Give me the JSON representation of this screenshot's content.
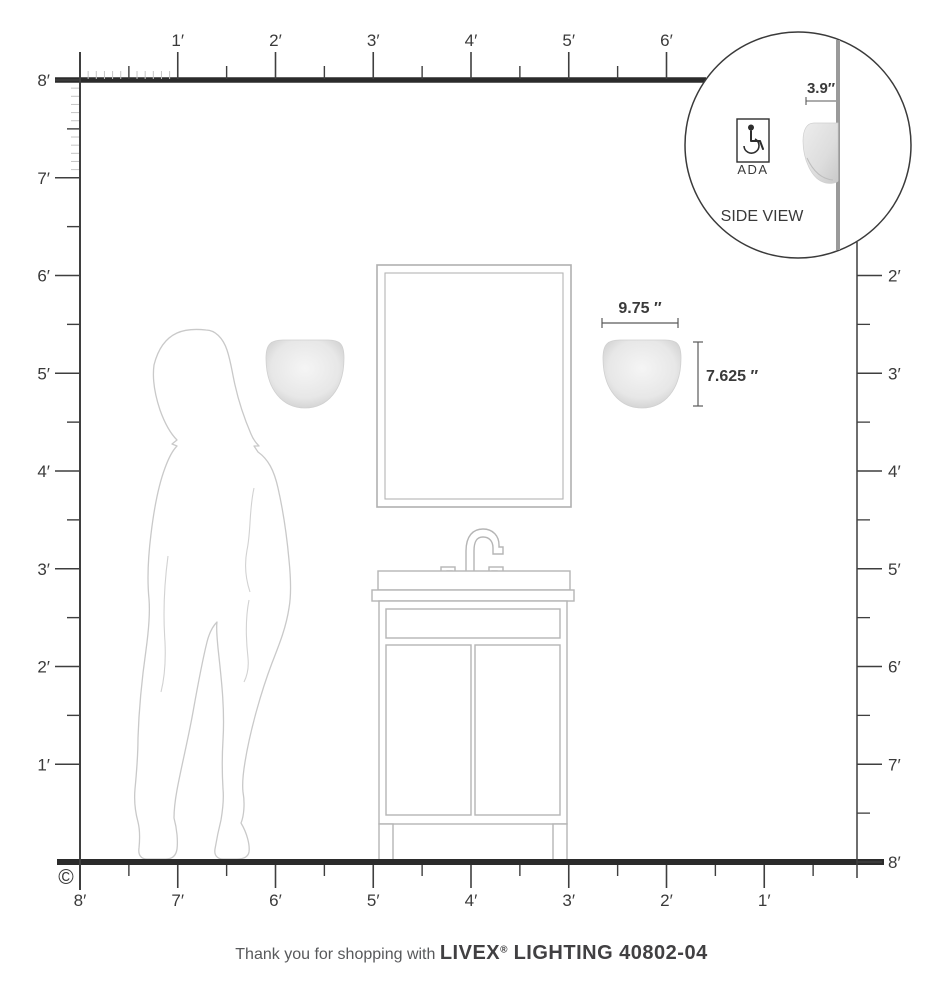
{
  "page": {
    "copyright": "©"
  },
  "footer": {
    "prefix": "Thank you for shopping with ",
    "brand": "LIVEX",
    "registered": "®",
    "suffix": " LIGHTING 40802-04"
  },
  "inset": {
    "dimension_label": "3.9″",
    "ada_label": "ADA",
    "view_label": "SIDE VIEW"
  },
  "fixture_dimensions": {
    "width_label": "9.75 ″",
    "height_label": "7.625 ″"
  },
  "rulers": {
    "top_labels": [
      "1′",
      "2′",
      "3′",
      "4′",
      "5′",
      "6′"
    ],
    "left_labels": [
      "8′",
      "7′",
      "6′",
      "5′",
      "4′",
      "3′",
      "2′",
      "1′"
    ],
    "right_labels": [
      "2′",
      "3′",
      "4′",
      "5′",
      "6′",
      "7′",
      "8′"
    ],
    "bottom_labels": [
      "8′",
      "7′",
      "6′",
      "5′",
      "4′",
      "3′",
      "2′",
      "1′"
    ]
  },
  "colors": {
    "ruler_dark": "#3f3f3f",
    "ruler_light": "#c4c4c4",
    "structure_dark": "#2b2b2b",
    "outline_gray": "#b5b5b5",
    "silhouette_gray": "#c9c9c9",
    "wall_gray": "#9a9a9a",
    "shade_light": "#f3f3f3",
    "shade_dark": "#cfcfcf"
  }
}
